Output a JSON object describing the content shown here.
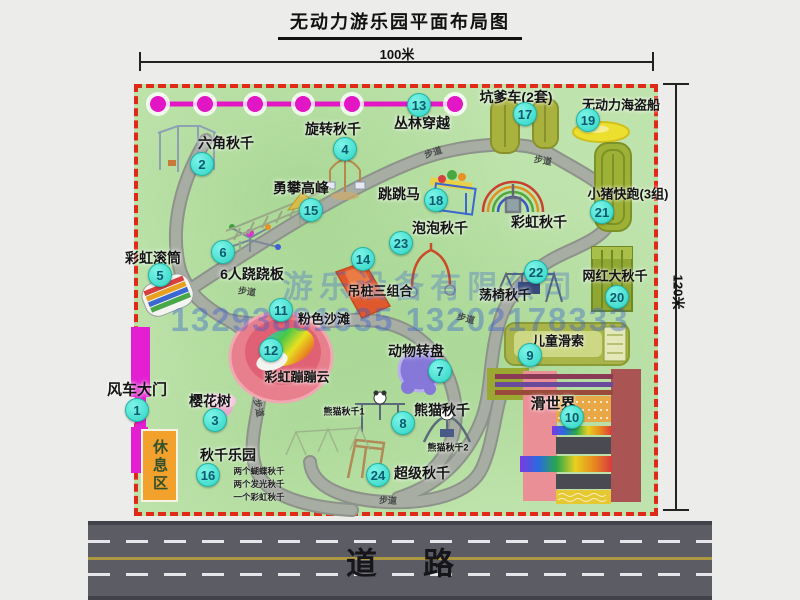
{
  "title": "无动力游乐园平面布局图",
  "dimension_labels": {
    "top": "100米",
    "right": "120米"
  },
  "road": {
    "label": "道路"
  },
  "watermark": {
    "company": "游乐设备有限公司",
    "phones": "13293881635 13202178333"
  },
  "rest_area_label": "休息区",
  "walkway_text": "步道",
  "walkway_labels": [
    {
      "x": 433,
      "y": 152,
      "rot": -18
    },
    {
      "x": 543,
      "y": 160,
      "rot": 10
    },
    {
      "x": 247,
      "y": 291,
      "rot": 8
    },
    {
      "x": 466,
      "y": 318,
      "rot": 15
    },
    {
      "x": 388,
      "y": 500,
      "rot": 3
    },
    {
      "x": 259,
      "y": 408,
      "rot": 78
    }
  ],
  "attractions": [
    {
      "num": "1",
      "label": "风车大门",
      "bx": 137,
      "by": 410,
      "lx": 137,
      "ly": 389,
      "fs": 15
    },
    {
      "num": "2",
      "label": "六角秋千",
      "bx": 202,
      "by": 164,
      "lx": 226,
      "ly": 143,
      "fs": 14
    },
    {
      "num": "3",
      "label": "樱花树",
      "bx": 215,
      "by": 420,
      "lx": 210,
      "ly": 401,
      "fs": 14
    },
    {
      "num": "4",
      "label": "旋转秋千",
      "bx": 345,
      "by": 149,
      "lx": 333,
      "ly": 129,
      "fs": 14
    },
    {
      "num": "5",
      "label": "彩虹滚筒",
      "bx": 160,
      "by": 275,
      "lx": 153,
      "ly": 258,
      "fs": 14
    },
    {
      "num": "6",
      "label": "6人跷跷板",
      "bx": 223,
      "by": 252,
      "lx": 252,
      "ly": 274,
      "fs": 14
    },
    {
      "num": "7",
      "label": "动物转盘",
      "bx": 440,
      "by": 371,
      "lx": 416,
      "ly": 351,
      "fs": 14
    },
    {
      "num": "8",
      "label": "熊猫秋千",
      "bx": 403,
      "by": 423,
      "lx": 442,
      "ly": 410,
      "fs": 14
    },
    {
      "num": "9",
      "label": "儿童滑索",
      "bx": 530,
      "by": 355,
      "lx": 558,
      "ly": 340,
      "fs": 13
    },
    {
      "num": "10",
      "label": "滑世界",
      "bx": 572,
      "by": 417,
      "lx": 553,
      "ly": 403,
      "fs": 15
    },
    {
      "num": "11",
      "label": "粉色沙滩",
      "bx": 281,
      "by": 310,
      "lx": 324,
      "ly": 318,
      "fs": 13
    },
    {
      "num": "12",
      "label": "彩虹蹦蹦云",
      "bx": 271,
      "by": 350,
      "lx": 297,
      "ly": 376,
      "fs": 13
    },
    {
      "num": "13",
      "label": "丛林穿越",
      "bx": 419,
      "by": 105,
      "lx": 422,
      "ly": 123,
      "fs": 14
    },
    {
      "num": "14",
      "label": "吊桩三组合",
      "bx": 363,
      "by": 259,
      "lx": 380,
      "ly": 290,
      "fs": 13
    },
    {
      "num": "15",
      "label": "勇攀高峰",
      "bx": 311,
      "by": 210,
      "lx": 301,
      "ly": 188,
      "fs": 14
    },
    {
      "num": "16",
      "label": "秋千乐园",
      "bx": 208,
      "by": 475,
      "lx": 228,
      "ly": 455,
      "fs": 14
    },
    {
      "num": "17",
      "label": "坑爹车(2套)",
      "bx": 525,
      "by": 114,
      "lx": 516,
      "ly": 97,
      "fs": 14
    },
    {
      "num": "18",
      "label": "跳跳马",
      "bx": 436,
      "by": 200,
      "lx": 399,
      "ly": 194,
      "fs": 14
    },
    {
      "num": "19",
      "label": "无动力海盗船",
      "bx": 588,
      "by": 120,
      "lx": 621,
      "ly": 104,
      "fs": 13
    },
    {
      "num": "20",
      "label": "网红大秋千",
      "bx": 617,
      "by": 297,
      "lx": 615,
      "ly": 275,
      "fs": 13
    },
    {
      "num": "21",
      "label": "小猪快跑(3组)",
      "bx": 602,
      "by": 212,
      "lx": 628,
      "ly": 193,
      "fs": 13
    },
    {
      "num": "22",
      "label": "荡椅秋千",
      "bx": 536,
      "by": 272,
      "lx": 505,
      "ly": 294,
      "fs": 13
    },
    {
      "num": "23",
      "label": "泡泡秋千",
      "bx": 401,
      "by": 243,
      "lx": 440,
      "ly": 228,
      "fs": 14
    },
    {
      "num": "24",
      "label": "超级秋千",
      "bx": 378,
      "by": 475,
      "lx": 422,
      "ly": 473,
      "fs": 14
    }
  ],
  "extra_labels": [
    {
      "text": "彩虹秋千",
      "x": 539,
      "y": 222,
      "fs": 14
    },
    {
      "text": "熊猫秋千1",
      "x": 344,
      "y": 411,
      "fs": 9
    },
    {
      "text": "熊猫秋千2",
      "x": 448,
      "y": 447,
      "fs": 9
    }
  ],
  "swing_park_notes": [
    "两个蝴蝶秋千",
    "两个发光秋千",
    "一个彩虹秋千"
  ],
  "colors": {
    "map_green": "#bfe3ac",
    "border_red": "#e02a18",
    "badge_cyan": "#3fe0d0",
    "garland_magenta": "#e316c6",
    "road_gray": "#5c5c64",
    "rest_area_orange": "#f2a12c",
    "watermark_blue": "#3a5fd0",
    "path_gray": "#a8ada4"
  }
}
